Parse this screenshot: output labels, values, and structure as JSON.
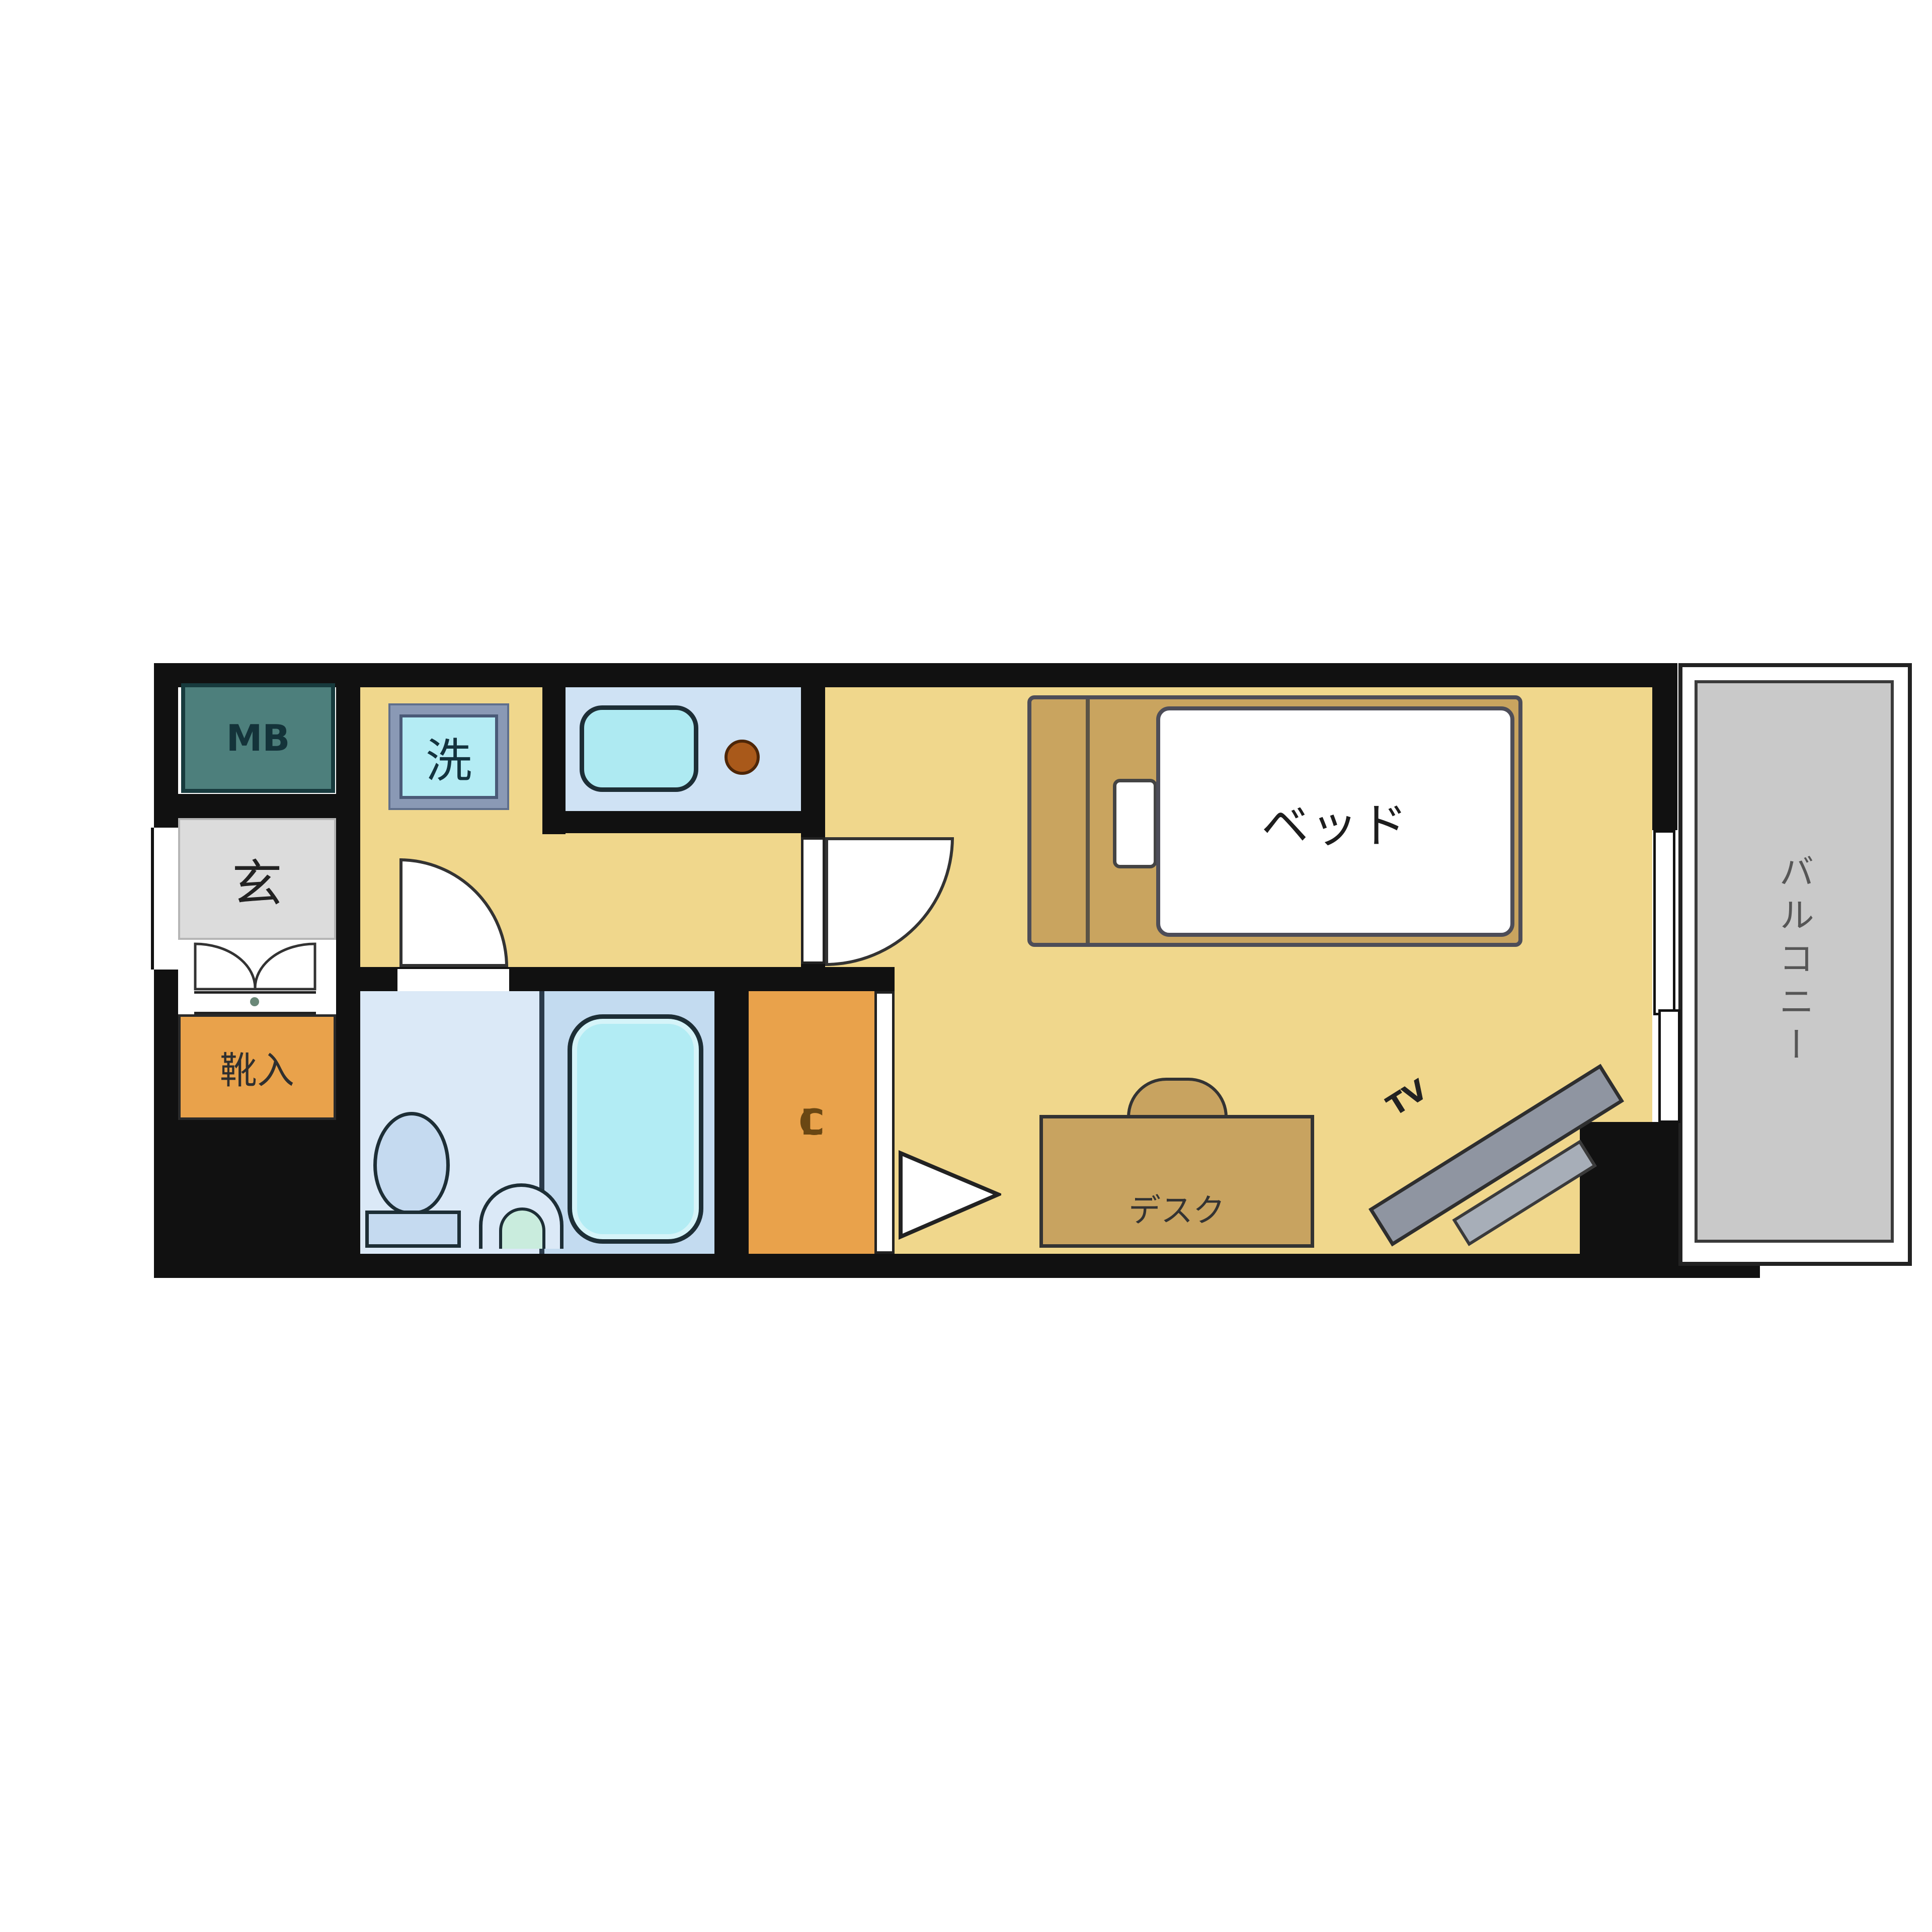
{
  "floorplan": {
    "labels": {
      "meter_box": "MB",
      "entrance": "玄",
      "shoe_cabinet": "靴入",
      "washing_machine": "洗",
      "closet_c": "C",
      "closet_l": "L",
      "bed": "ベッド",
      "desk": "デスク",
      "tv": "TV",
      "balcony": "バルコニー"
    },
    "colors": {
      "wall": "#111111",
      "floor_yellow": "#f0d78c",
      "meter_box_teal": "#4d7f7c",
      "entrance_gray": "#dcdcdc",
      "storage_orange": "#e9a24b",
      "kitchen_counter_blue": "#cfe2f4",
      "fixture_cyan": "#b2ecf4",
      "toilet_room_blue": "#dbe9f7",
      "bath_room_blue": "#c3dbf0",
      "wood_tan": "#c9a45f",
      "tv_gray": "#8f95a1",
      "balcony_gray": "#c9c9c9",
      "burner_orange": "#a9591a",
      "washer_frame_slate": "#8a99b5"
    }
  }
}
